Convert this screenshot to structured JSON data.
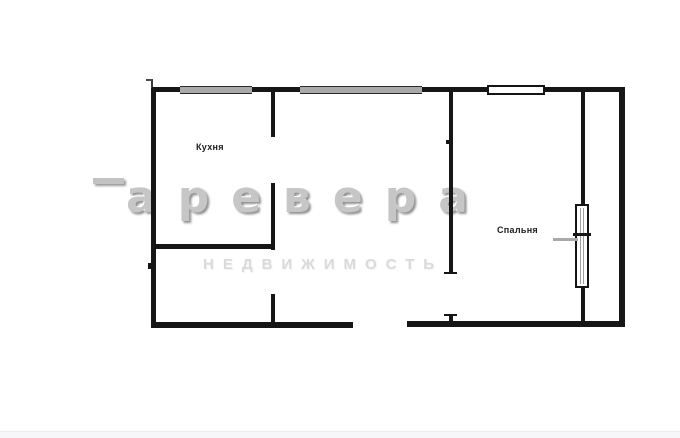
{
  "plan": {
    "type": "apartment-floor-plan",
    "rooms": [
      {
        "label": "Кухня"
      },
      {
        "label": "Спальня"
      }
    ],
    "wall_color": "#161616",
    "window_bar_color": "#a9a9a9",
    "background_color": "#ffffff"
  },
  "watermark": {
    "brand": "аревера",
    "subtitle": "НЕДВИЖИМОСТЬ",
    "brand_color": "#c6c6c6",
    "subtitle_color": "#dadada"
  },
  "footer": {
    "strip_color": "#f7f7f9"
  }
}
